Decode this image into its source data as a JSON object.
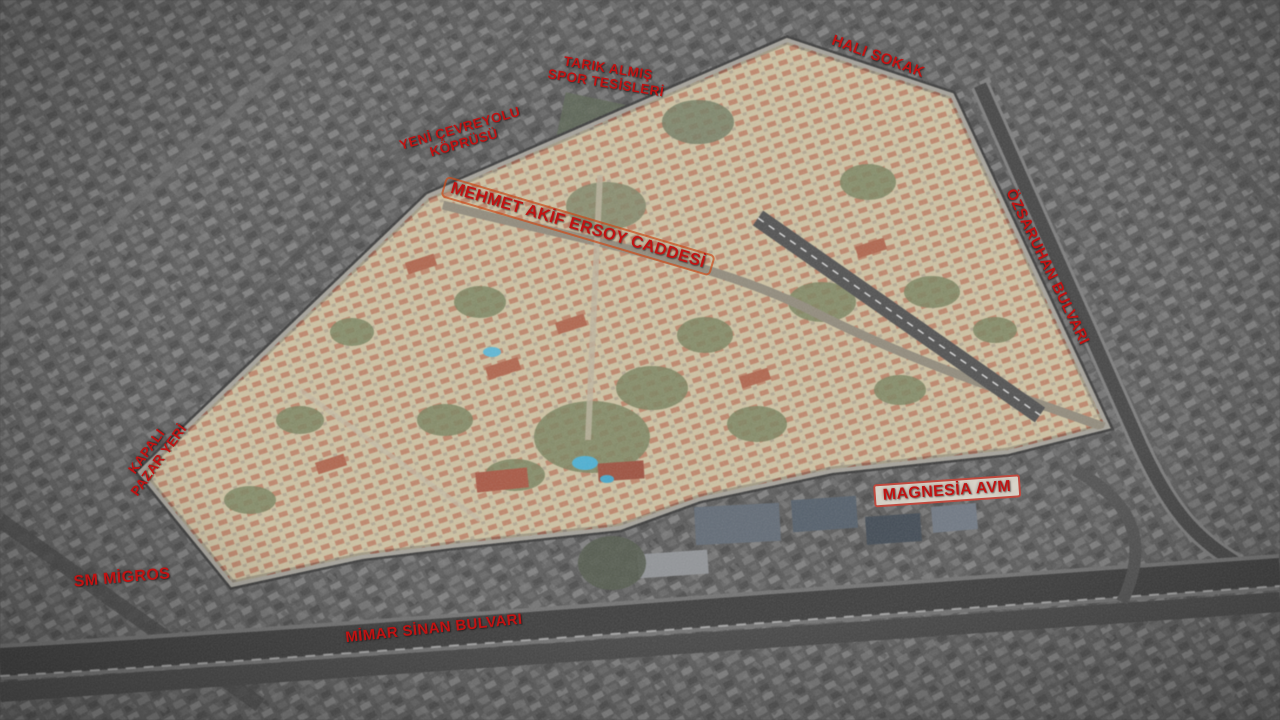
{
  "map": {
    "description": "Annotated aerial photograph: highlighted residential district surrounded by desaturated city, with red Turkish street and landmark labels",
    "label_color": "#c11212",
    "site_fill": "#cfc3a2",
    "labels": [
      {
        "id": "tarik-almis-spor-tesisleri",
        "lines": [
          "TARIK ALMIŞ",
          "SPOR TESİSLERİ"
        ]
      },
      {
        "id": "cevreyolu-koprusu",
        "lines": [
          "YENİ ÇEVREYOLU",
          "KÖPRÜSÜ"
        ]
      },
      {
        "id": "hali-sokak",
        "lines": [
          "HALI SOKAK"
        ]
      },
      {
        "id": "mehmet-akif-ersoy-caddesi",
        "lines": [
          "MEHMET AKİF ERSOY CADDESİ"
        ]
      },
      {
        "id": "ozsaruhan-bulvari",
        "lines": [
          "ÖZSARUHAN BULVARI"
        ]
      },
      {
        "id": "kapali-pazar-yeri",
        "lines": [
          "KAPALI",
          "PAZAR YERİ"
        ]
      },
      {
        "id": "sm-migros",
        "lines": [
          "SM MİGROS"
        ]
      },
      {
        "id": "magnesia-avm",
        "lines": [
          "MAGNESİA AVM"
        ]
      },
      {
        "id": "mimar-sinan-bulvari",
        "lines": [
          "MİMAR SİNAN BULVARI"
        ]
      }
    ]
  }
}
